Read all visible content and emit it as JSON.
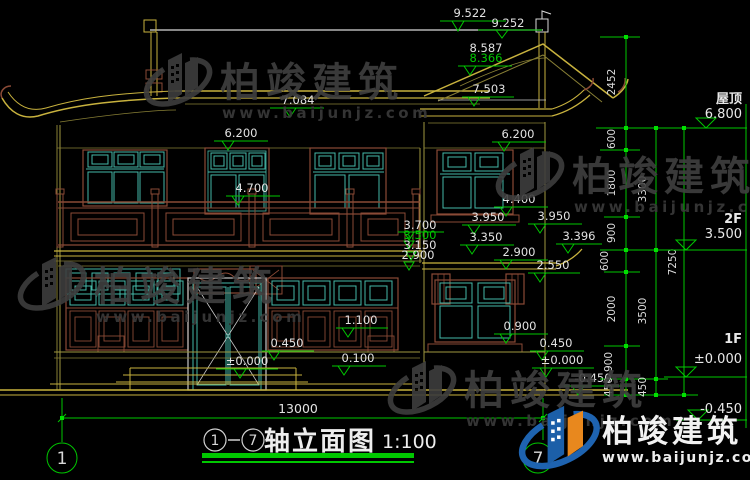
{
  "drawing": {
    "title": {
      "axis_start": "1",
      "axis_end": "7",
      "name": "轴立面图",
      "scale": "1:100"
    },
    "overall_width_mm": "13000",
    "axis_bubbles": {
      "left": "1",
      "right": "7"
    },
    "spots": [
      "9.522",
      "9.252",
      "8.587",
      "8.366",
      "7.503",
      "7.084",
      "6.200",
      "6.200",
      "4.700",
      "4.400",
      "3.950",
      "3.950",
      "3.700",
      "3.500",
      "3.150",
      "2.900",
      "3.350",
      "3.396",
      "2.900",
      "2.550",
      "1.100",
      "0.450",
      "0.100",
      "±0.000",
      "0.900",
      "0.450",
      "±0.000",
      "-0.450"
    ],
    "levels": [
      {
        "label": "屋顶",
        "value": "6.800"
      },
      {
        "label": "2F",
        "value": "3.500"
      },
      {
        "label": "1F",
        "value": "±0.000"
      },
      {
        "label": "",
        "value": "-0.450"
      }
    ],
    "chains": {
      "c1": [
        "2452",
        "600",
        "1800",
        "900",
        "600",
        "2000",
        "900",
        "450"
      ],
      "c2": [
        "3300",
        "3500",
        "450"
      ],
      "c3": [
        "7250"
      ]
    }
  },
  "brand": {
    "name": "柏竣建筑",
    "url": "www.baijunjz.com"
  },
  "colors": {
    "dim_green": "#00C800",
    "tick_green": "#00E000",
    "line_white": "#D8D8D8",
    "window_teal": "#45B8A8",
    "wood_brown": "#8A4A36",
    "roof_gold": "#C8B23E",
    "watermark_gray": "#404040",
    "logo_blue": "#1C5FA8",
    "logo_orange": "#E8881E"
  }
}
